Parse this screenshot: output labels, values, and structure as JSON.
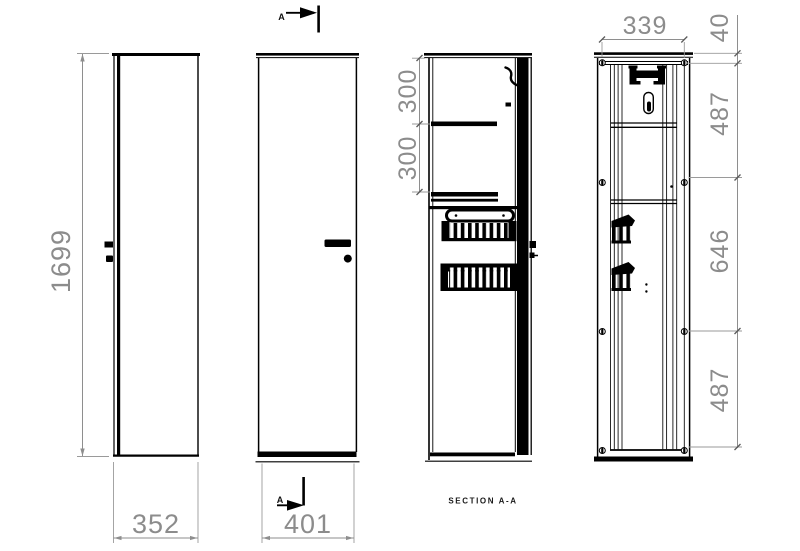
{
  "drawing": {
    "section_label": "SECTION A-A",
    "cut_top_label": "A",
    "cut_bottom_label": "A",
    "dims": {
      "height": "1699",
      "side_depth": "352",
      "front_width": "401",
      "shelf_top": "300",
      "shelf_bottom": "300",
      "back_width": "339",
      "back_top_offset": "40",
      "back_upper": "487",
      "back_middle": "646",
      "back_lower": "487"
    },
    "colors": {
      "line": "#000000",
      "dimension": "#8c8c8c",
      "background": "#ffffff"
    }
  }
}
